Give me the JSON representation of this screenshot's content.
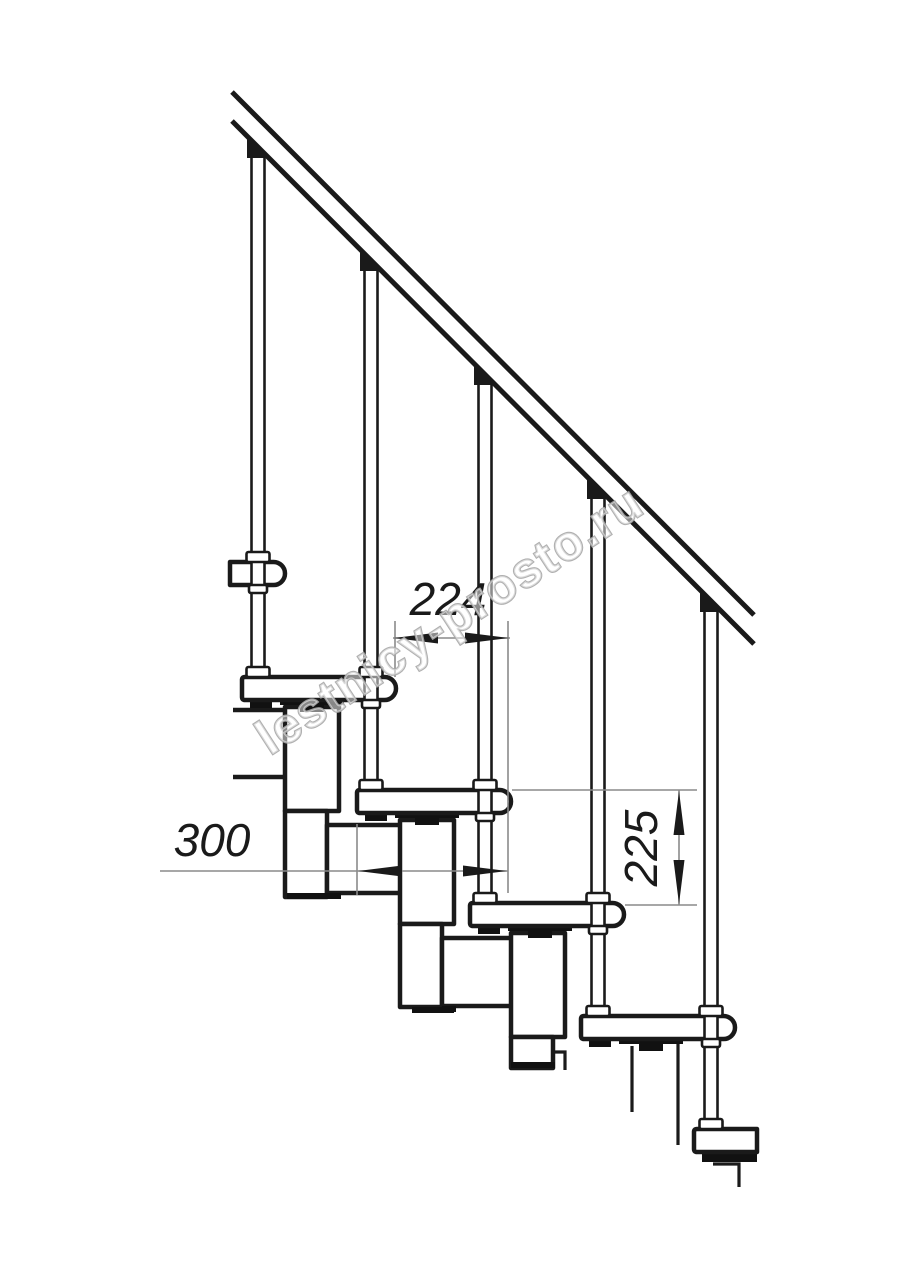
{
  "dimensions": {
    "tread_offset": "224",
    "tread_depth": "300",
    "riser_height": "225"
  },
  "watermark": {
    "text": "lestnicy-prosto.ru"
  },
  "colors": {
    "background": "#ffffff",
    "line": "#1a1a1a",
    "dimension_line": "#8a8a8a",
    "dimension_text": "#1a1a1a",
    "watermark": "#a8a8a8"
  }
}
